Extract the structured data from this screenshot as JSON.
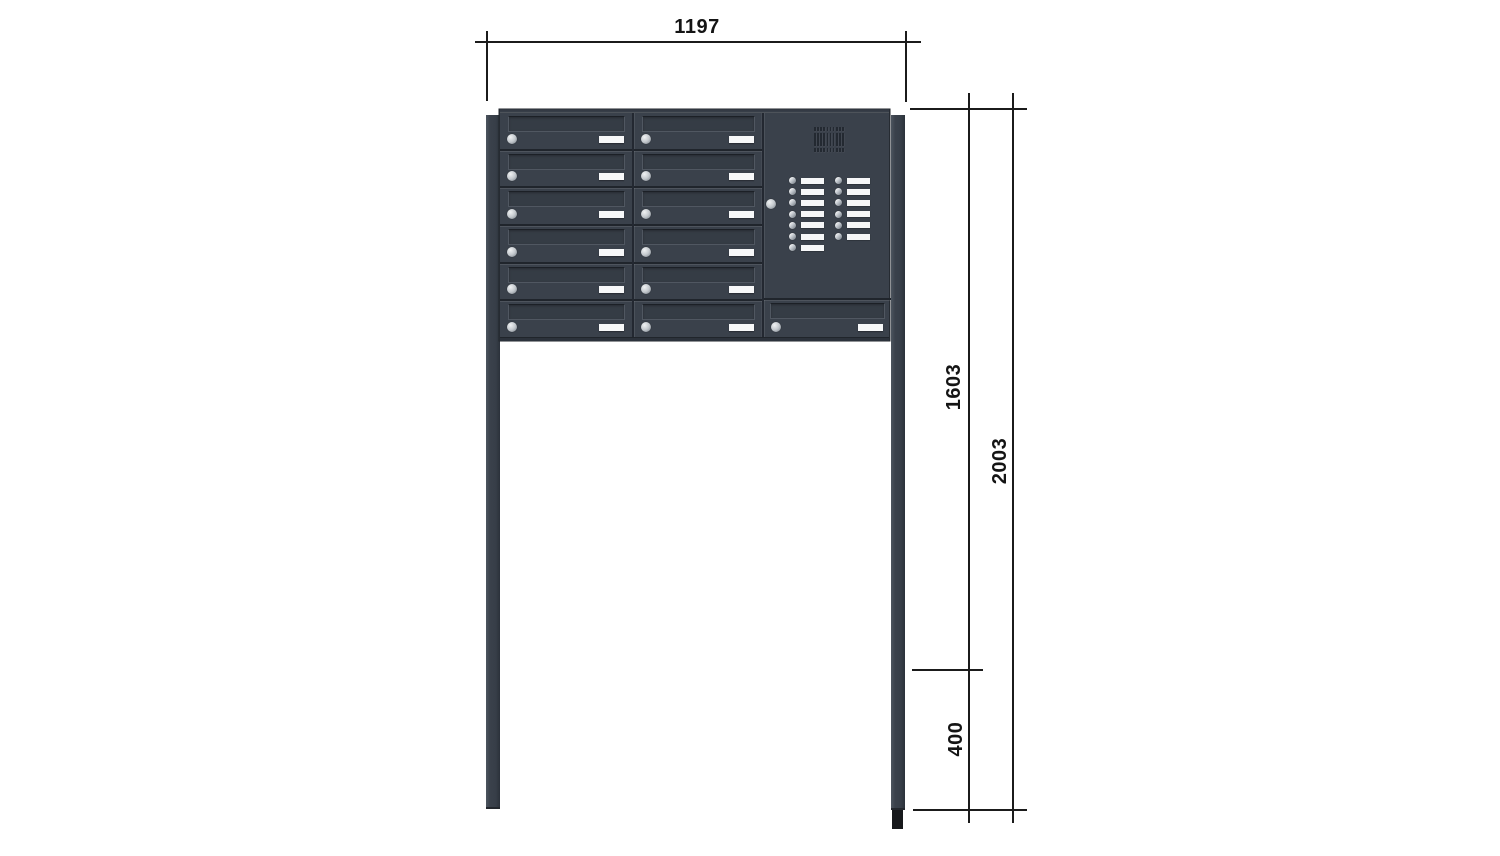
{
  "drawing": {
    "subject": "free-standing letterbox bank with intercom panel",
    "background": "#ffffff",
    "line_color": "#1b1b1b"
  },
  "dimensions": {
    "width": "1197",
    "upper_height": "1603",
    "total_height": "2003",
    "ground_offset": "400"
  },
  "unit": {
    "mailbox_columns": 2,
    "mailbox_rows_per_column": 6,
    "boxes_under_intercom": 1,
    "bell_rows_left": 7,
    "bell_rows_right": 6,
    "grille_columns": 10,
    "colors": {
      "body": "#3a414b",
      "body_dark": "#232831",
      "body_light": "#4d555f",
      "nameplate": "#f7f8f9",
      "lock": "#c3c8cd",
      "ground_anchor": "#17191c"
    }
  }
}
